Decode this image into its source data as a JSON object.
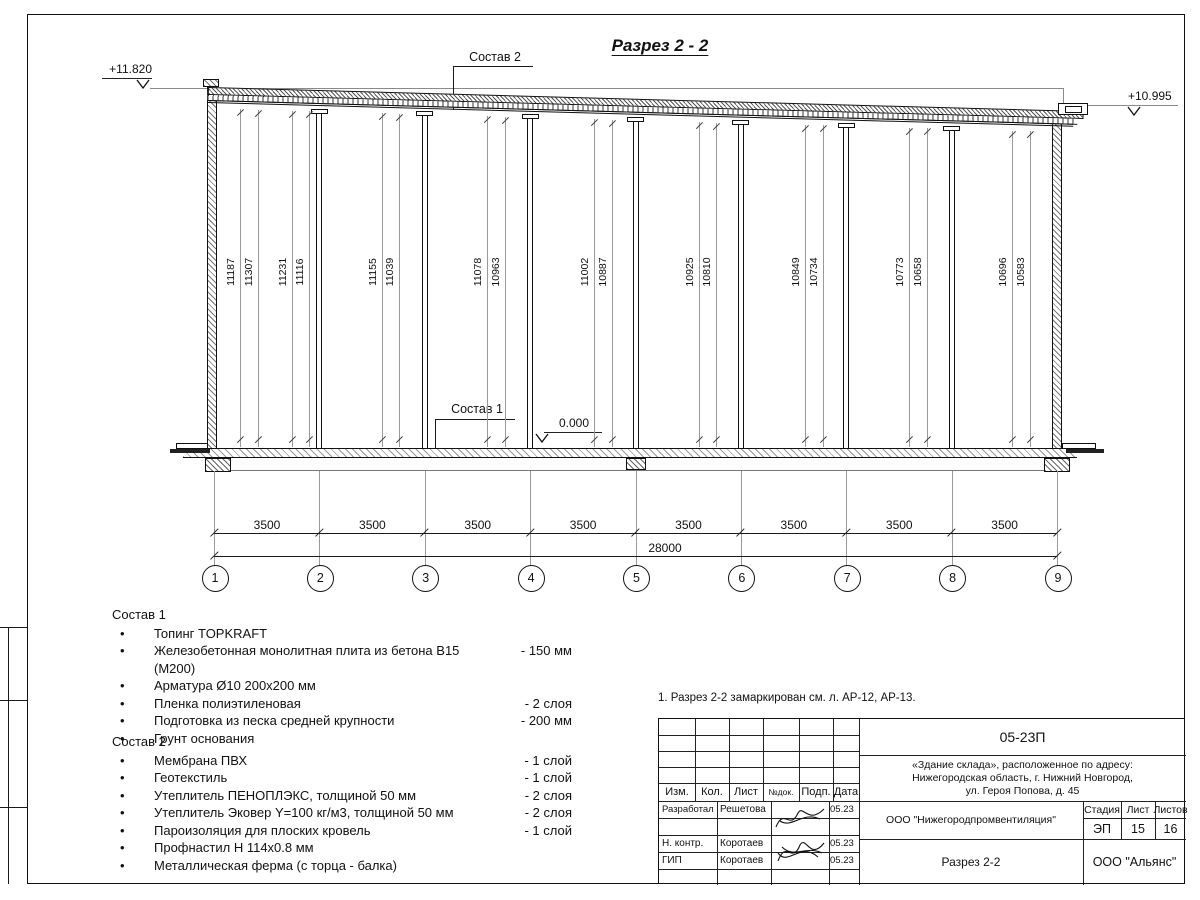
{
  "sheet": {
    "title": "Разрез 2 - 2"
  },
  "elevations": {
    "left": "+11.820",
    "right": "+10.995",
    "zero": "0.000"
  },
  "callouts": {
    "roof": "Состав 2",
    "floor": "Состав 1"
  },
  "height_dims": [
    "11187",
    "11307",
    "11231",
    "11116",
    "11155",
    "11039",
    "11078",
    "10963",
    "11002",
    "10887",
    "10925",
    "10810",
    "10849",
    "10734",
    "10773",
    "10658",
    "10696",
    "10583"
  ],
  "grid_numbers": [
    "1",
    "2",
    "3",
    "4",
    "5",
    "6",
    "7",
    "8",
    "9"
  ],
  "bay_dims": [
    "3500",
    "3500",
    "3500",
    "3500",
    "3500",
    "3500",
    "3500",
    "3500"
  ],
  "total_dim": "28000",
  "sostav1": {
    "title": "Состав 1",
    "items": [
      {
        "text": "Топинг TOPKRAFT",
        "qty": ""
      },
      {
        "text": "Железобетонная монолитная плита из бетона В15 (М200)",
        "qty": "-  150 мм"
      },
      {
        "text": "Арматура Ø10 200x200 мм",
        "qty": ""
      },
      {
        "text": "Пленка полиэтиленовая",
        "qty": "-  2 слоя"
      },
      {
        "text": "Подготовка из песка средней крупности",
        "qty": "- 200 мм"
      },
      {
        "text": "Грунт основания",
        "qty": ""
      }
    ]
  },
  "sostav2": {
    "title": "Состав 2",
    "items": [
      {
        "text": "Мембрана ПВХ",
        "qty": "- 1 слой"
      },
      {
        "text": "Геотекстиль",
        "qty": "- 1 слой"
      },
      {
        "text": "Утеплитель ПЕНОПЛЭКС, толщиной 50 мм",
        "qty": "- 2 слоя"
      },
      {
        "text": "Утеплитель Эковер Y=100 кг/м3, толщиной 50 мм",
        "qty": "- 2 слоя"
      },
      {
        "text": "Пароизоляция для плоских кровель",
        "qty": "- 1 слой"
      },
      {
        "text": "Профнастил Н 114x0.8 мм",
        "qty": ""
      },
      {
        "text": "Металлическая ферма (с торца - балка)",
        "qty": ""
      }
    ]
  },
  "note": "1. Разрез 2-2 замаркирован см. л. АР-12, АР-13.",
  "titleblock": {
    "code": "05-23П",
    "address_lines": [
      "«Здание склада», расположенное по адресу:",
      "Нижегородская область, г. Нижний Новгород,",
      "ул. Героя Попова, д. 45"
    ],
    "header_cols": [
      "Изм.",
      "Кол.",
      "Лист",
      "№док.",
      "Подп.",
      "Дата"
    ],
    "rows": [
      {
        "role": "Разработал",
        "name": "Решетова",
        "date": "05.23"
      },
      {
        "role": "Н. контр.",
        "name": "Коротаев",
        "date": "05.23"
      },
      {
        "role": "ГИП",
        "name": "Коротаев",
        "date": "05.23"
      }
    ],
    "org": "ООО \"Нижегородпромвентиляция\"",
    "stage_label": "Стадия",
    "sheet_label": "Лист",
    "sheets_label": "Листов",
    "stage": "ЭП",
    "sheet_no": "15",
    "sheets_total": "16",
    "drawing_name": "Разрез 2-2",
    "company": "ООО \"Альянс\""
  }
}
